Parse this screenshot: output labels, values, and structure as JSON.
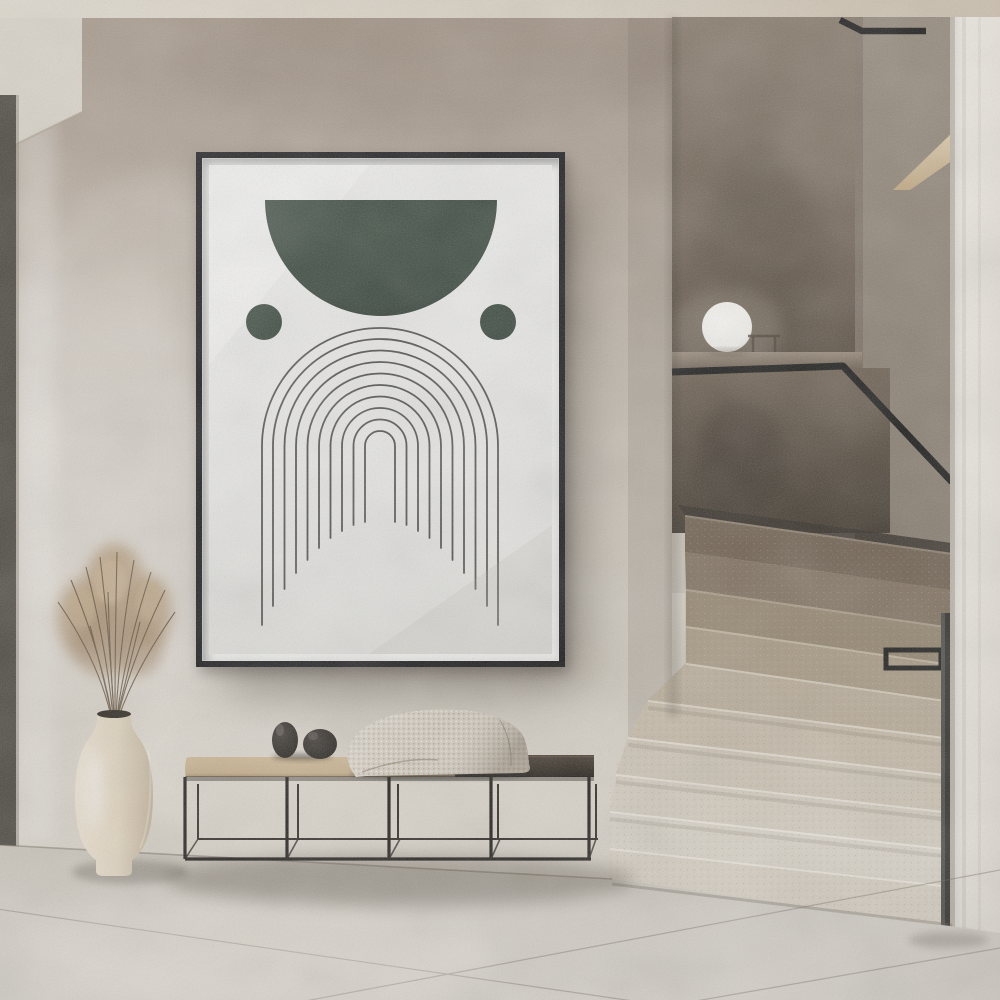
{
  "meta": {
    "description": "Minimalist interior hallway: framed abstract line-art poster on textured plaster wall, black metal bench with cushion, decor balls and waffle blanket, cream vase with dried grass, terrazzo quarter-turn staircase with black handrail and white sphere lamp",
    "canvas": {
      "width": 1000,
      "height": 1000
    }
  },
  "palette": {
    "ceiling": "#ded8cd",
    "soffit": "#d8d3c9",
    "wall-top": "#a39486",
    "wall-mid": "#cbc4b9",
    "wall-light": "#ddd8ce",
    "door-frame": "#45423a",
    "niche-panel-top": "#847768",
    "niche-panel-bottom": "#554a3e",
    "niche-right-top": "#a89f93",
    "niche-right-bottom": "#6e6254",
    "half-wall-top": "#6e6152",
    "half-wall-bottom": "#3d352b",
    "ledge-top": "#998b7a",
    "ledge-bottom": "#6f6152",
    "lamp": "#f6f4f0",
    "rail": "#141414",
    "wood-accent": "#d9c3a2",
    "post": "#2e2e2c",
    "pillar": "#efece6",
    "floor": "#d9d5cd",
    "floor-far": "#ccc7bc",
    "frame": "#17171a",
    "paper": "#eaeae8",
    "art-green": "#2e3d33",
    "art-line": "#3b3b39",
    "bench-frame": "#1e1c19",
    "cushion": "#c9b28f",
    "bench-top": "#2b2520",
    "blanket": "#d8d0c3",
    "ball": "#1d1a16",
    "vase-light": "#f0e6d6",
    "vase-shadow": "#c6b69e",
    "plant": "#b29878",
    "shadow": "#4a4136"
  },
  "poster": {
    "subject": "abstract boho arch line art",
    "frame_color": "#17171a",
    "paper_color": "#eaeae8",
    "accent_green": "#2e3d33",
    "line_color": "#3b3b39",
    "arch_count": 10,
    "elements": [
      "dark green half-circle",
      "two green side dots",
      "concentric arches with dome-trimmed legs"
    ]
  },
  "staircase": {
    "material": "terrazzo stone",
    "steps_visible": 10,
    "handrail_color": "#141414",
    "step_colors": [
      "#6f6050",
      "#80715f",
      "#95866f",
      "#ab9c86",
      "#beb19d",
      "#cbc0ae",
      "#d4cbbb",
      "#dad3c6",
      "#e0dacf",
      "#ddd6ca"
    ]
  },
  "objects": {
    "lamp": {
      "shape": "sphere",
      "color": "#f6f4f0",
      "location": "stair ledge"
    },
    "bench": {
      "frame": "black metal",
      "seat_left": "tan cushion",
      "seat_right": "dark wood",
      "decor": [
        "two black stone balls",
        "cream waffle-knit blanket"
      ]
    },
    "vase": {
      "color": "cream",
      "contents": "dried grass bouquet"
    },
    "wood_accent": {
      "description": "diagonal wood handrail piece on upper wall"
    },
    "door_frame": {
      "color": "#45423a",
      "location": "far left edge"
    }
  }
}
